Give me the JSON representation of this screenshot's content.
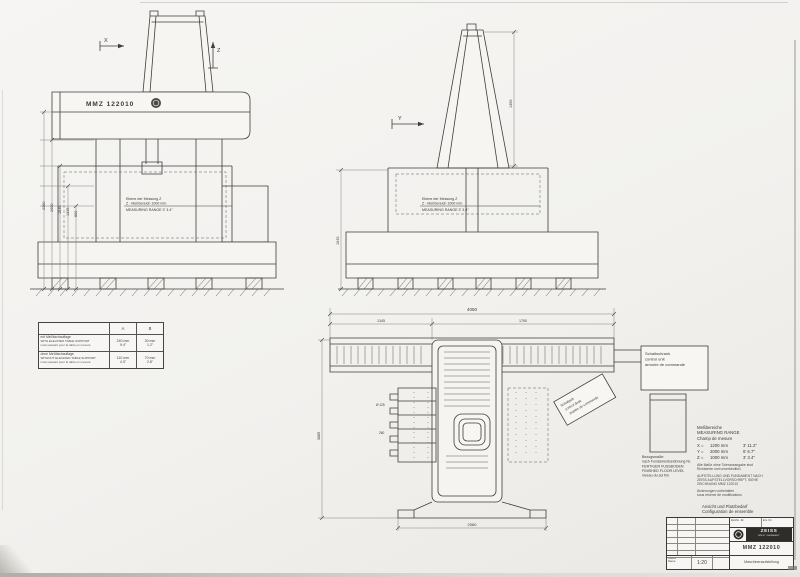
{
  "sheet": {
    "bg": "#f1f0ec",
    "line_color": "#3e3d3a"
  },
  "front_view": {
    "machine_label": "MMZ 122010",
    "axis_x": "X",
    "axis_z": "Z",
    "dim1": "2360",
    "dim2": "2000",
    "dim3": "1545",
    "dim4": "1345",
    "dim5": "800",
    "note_l1": "Ebene der Messung Z",
    "note_l2": "Z - Meßbereich 1000 mm",
    "note_l3": "MEASURING RANGE 3' 3.4\""
  },
  "side_view": {
    "axis_y": "Y",
    "dim_left": "1045",
    "dim_right": "1355",
    "note_l1": "Ebene der Messung Z",
    "note_l2": "Z - Meßbereich 1000 mm",
    "note_l3": "MEASURING RANGE 3' 3.4\""
  },
  "plan_view": {
    "dim_overall": "4050",
    "dim_sub_left": "1345",
    "dim_sub_right": "1750",
    "dim_depth": "3685",
    "dim_bottom": "2060",
    "dim_comb1": "Ø 125",
    "dim_comb2": "260",
    "cabinet_l1": "Schaltschrank",
    "cabinet_l2": "control unit",
    "cabinet_l3": "armoire de commande",
    "desk_l1": "Schaltpult",
    "desk_l2": "control desk",
    "desk_l3": "pupitre de commande",
    "floor_l1": "Bezugsmaße:",
    "floor_l2": "nach Fundamentzeichnung Nr.",
    "floor_l3": "FERTIGER FUSSBODEN",
    "floor_l4": "FINISHED FLOOR LEVEL",
    "floor_l5": "niveau du sol fini"
  },
  "clearance_table": {
    "col_a": "A",
    "col_b": "B",
    "r1_de": "mit Meßtischauflage",
    "r1_en": "WITH ELEVATED TABLE SUPPORT",
    "r1_fr": "maxi passant pour la table en mesure",
    "r1_a_mm": "240 mm",
    "r1_a_in": "9.4\"",
    "r1_b_mm": "30 mm",
    "r1_b_in": "1.2\"",
    "r2_de": "ohne Meßtischauflage",
    "r2_en": "WITHOUT ELEVATED TABLE SUPPORT",
    "r2_fr": "maxi passant pour la table en mesure",
    "r2_a_mm": "110 mm",
    "r2_a_in": "4.3\"",
    "r2_b_mm": "70 mm",
    "r2_b_in": "2.8\""
  },
  "measuring_ranges": {
    "title_de": "Meßbereiche",
    "title_en": "MEASURING RANGE",
    "title_fr": "Champ de mesure",
    "x_axis": "X =",
    "x_mm": "1200 mm",
    "x_imp": "3' 11.2\"",
    "y_axis": "Y =",
    "y_mm": "2000 mm",
    "y_imp": "6'  6.7\"",
    "z_axis": "Z =",
    "z_mm": "1000 mm",
    "z_imp": "3'  3.4\"",
    "note1_l1": "Alle Maße ohne Toleranzangabe sind",
    "note1_l2": "Richtwerte und unverbindlich",
    "note2_l1": "AUFSTELLUNG UND FUNDAMENT NACH",
    "note2_l2": "ZEISS AUFSTELLVORSCHRIFT, SIEHE",
    "note2_l3": "ZEICHNUNG MMZ 122010",
    "note3_l1": "Änderungen vorbehalten",
    "note3_l2": "sous réserve de modifications"
  },
  "title_block": {
    "pre_l1": "Ansicht und Platzbedarf",
    "pre_l2": "Configuration de ensemble",
    "cell_date": "Datum",
    "cell_name": "Name",
    "cell_drawno": "Zeichn.-Nr.",
    "cell_repl": "Ers. für",
    "scale": "1:20",
    "brand": "ZEISS",
    "brand_sub": "WEST GERMANY",
    "part_number": "MMZ 122010",
    "doc_name": "Maschinenaufstellung"
  }
}
